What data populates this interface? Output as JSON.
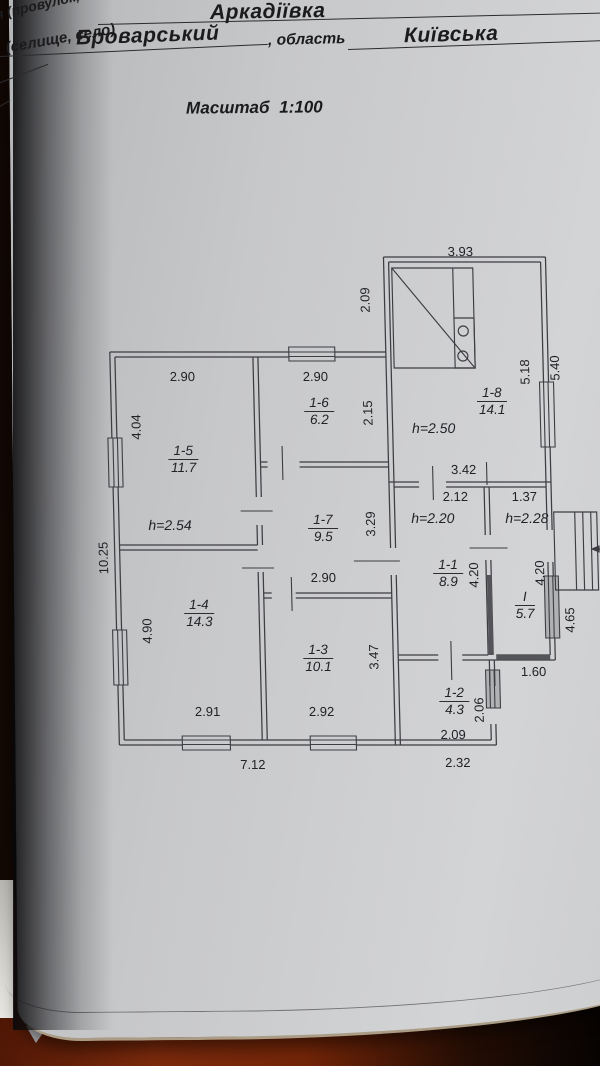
{
  "header": {
    "partial_top": "я (провулок,",
    "settlement_label": "(селище, село)",
    "settlement_value": "Аркадіївка",
    "district_value": "Броварський",
    "oblast_label": ", область",
    "oblast_value": "Київська",
    "scale_label": "Масштаб 1:100"
  },
  "plan": {
    "dims": [
      {
        "t": "3.93"
      },
      {
        "t": "2.09"
      },
      {
        "t": "2.90"
      },
      {
        "t": "2.90"
      },
      {
        "t": "2.15"
      },
      {
        "t": "4.04"
      },
      {
        "t": "5.18"
      },
      {
        "t": "5.40"
      },
      {
        "t": "10.25"
      },
      {
        "t": "3.29"
      },
      {
        "t": "2.90"
      },
      {
        "t": "4.90"
      },
      {
        "t": "3.47"
      },
      {
        "t": "2.91"
      },
      {
        "t": "2.92"
      },
      {
        "t": "7.12"
      },
      {
        "t": "3.42"
      },
      {
        "t": "2.12"
      },
      {
        "t": "1.37"
      },
      {
        "t": "4.20"
      },
      {
        "t": "4.20"
      },
      {
        "t": "4.65"
      },
      {
        "t": "1.60"
      },
      {
        "t": "2.06"
      },
      {
        "t": "2.09"
      },
      {
        "t": "2.32"
      }
    ],
    "heights": [
      {
        "t": "h=2.54"
      },
      {
        "t": "h=2.50"
      },
      {
        "t": "h=2.20"
      },
      {
        "t": "h=2.28"
      }
    ],
    "rooms": [
      {
        "num": "1-5",
        "area": "11.7"
      },
      {
        "num": "1-6",
        "area": "6.2"
      },
      {
        "num": "1-7",
        "area": "9.5"
      },
      {
        "num": "1-4",
        "area": "14.3"
      },
      {
        "num": "1-3",
        "area": "10.1"
      },
      {
        "num": "1-1",
        "area": "8.9"
      },
      {
        "num": "I",
        "area": "5.7"
      },
      {
        "num": "1-2",
        "area": "4.3"
      },
      {
        "num": "1-8",
        "area": "14.1"
      }
    ]
  }
}
